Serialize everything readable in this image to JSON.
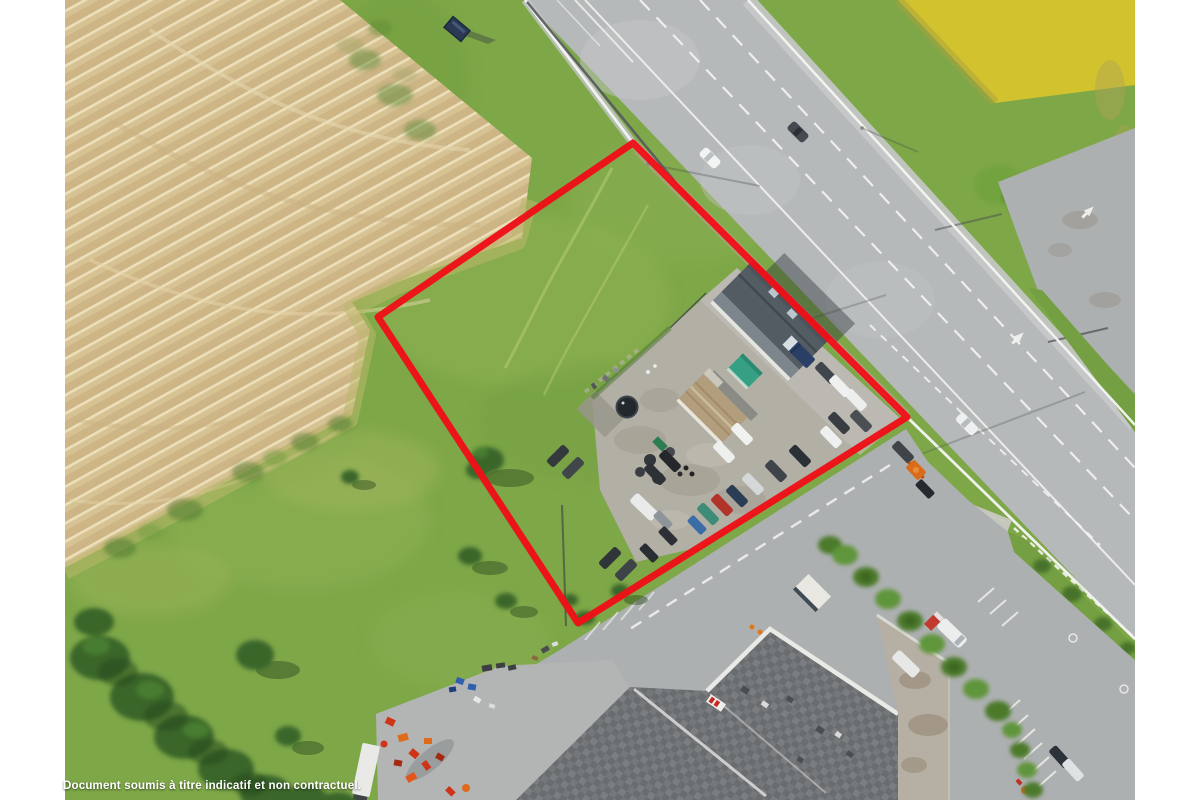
{
  "disclaimer": {
    "text": "Document soumis à titre indicatif et non contractuel."
  },
  "parcel_outline": {
    "color": "#ee1118",
    "stroke_width": "7",
    "points": "633,143 907,417 578,623 378,317"
  },
  "palette": {
    "page_bg": "#ffffff",
    "grass": "#7ea748",
    "grass_light": "#9cbb5c",
    "grass_dark": "#5e8a35",
    "field": "#d7c294",
    "field_light": "#ecdfb9",
    "field_dark": "#cdb586",
    "dry_grass": "#b9b86c",
    "road": "#b6b9ba",
    "pavement": "#adb0b1",
    "concrete": "#c8c8c1",
    "marking": "#f4f5f3",
    "roof_dark": "#535c63",
    "roof_tan": "#b29e7c",
    "roof_tiles": "#6a6d70",
    "roof_light": "#b6b0a4",
    "teal_canopy": "#35a084",
    "yellow_field": "#d2c32e",
    "hedge": "#4c7a2c",
    "tree": "#3a6629",
    "guardrail": "#55595c"
  },
  "scene": {
    "regions": [
      "harvested-field",
      "grass-parcel",
      "highway",
      "roadside-billboard",
      "yellow-field",
      "layby",
      "junction",
      "bus-shelter",
      "car-dealership-yard",
      "house-roof",
      "garage-roof",
      "industrial-buildings",
      "machinery-yard",
      "hedgerows",
      "trees",
      "parked-cars",
      "white-van",
      "parcel-outline"
    ]
  }
}
